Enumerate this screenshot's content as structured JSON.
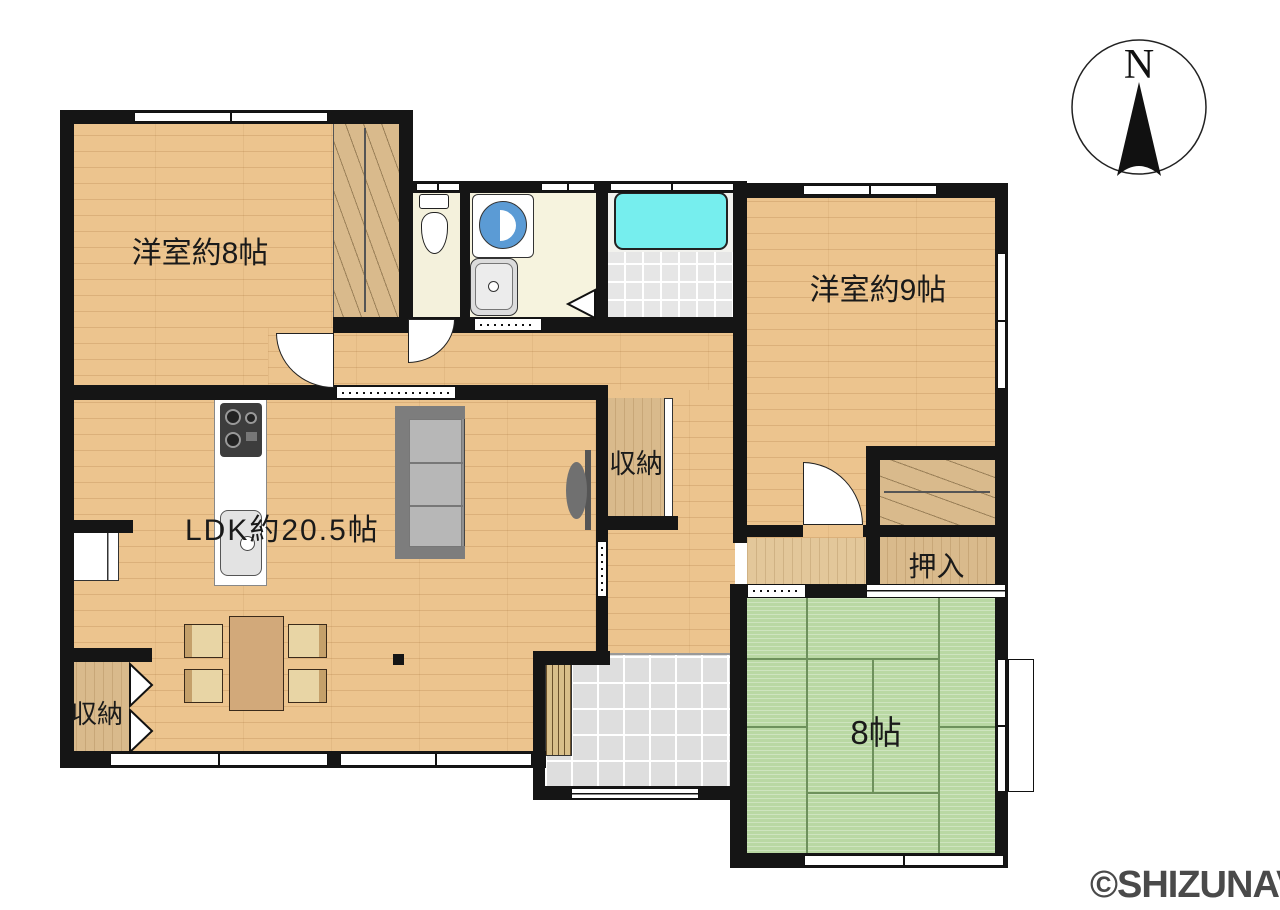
{
  "labels": {
    "room_west_8": "洋室約8帖",
    "room_west_9": "洋室約9帖",
    "ldk": "LDK約20.5帖",
    "storage_mid": "収納",
    "storage_entry": "収納",
    "oshiire": "押入",
    "tatami_8": "8帖",
    "compass_n": "N",
    "watermark": "©SHIZUNAVI"
  },
  "colors": {
    "wall": "#151515",
    "wood_floor": "#ecc48e",
    "closet_wood": "#d9ba8c",
    "tatami_green": "#b9d8a3",
    "wet_room_floor": "#f4f1dc",
    "bathtub": "#76eeee",
    "washer_drum": "#5b9bd5",
    "entrance_tile": "#dedede",
    "watermark_gray": "#4a4a4a"
  }
}
